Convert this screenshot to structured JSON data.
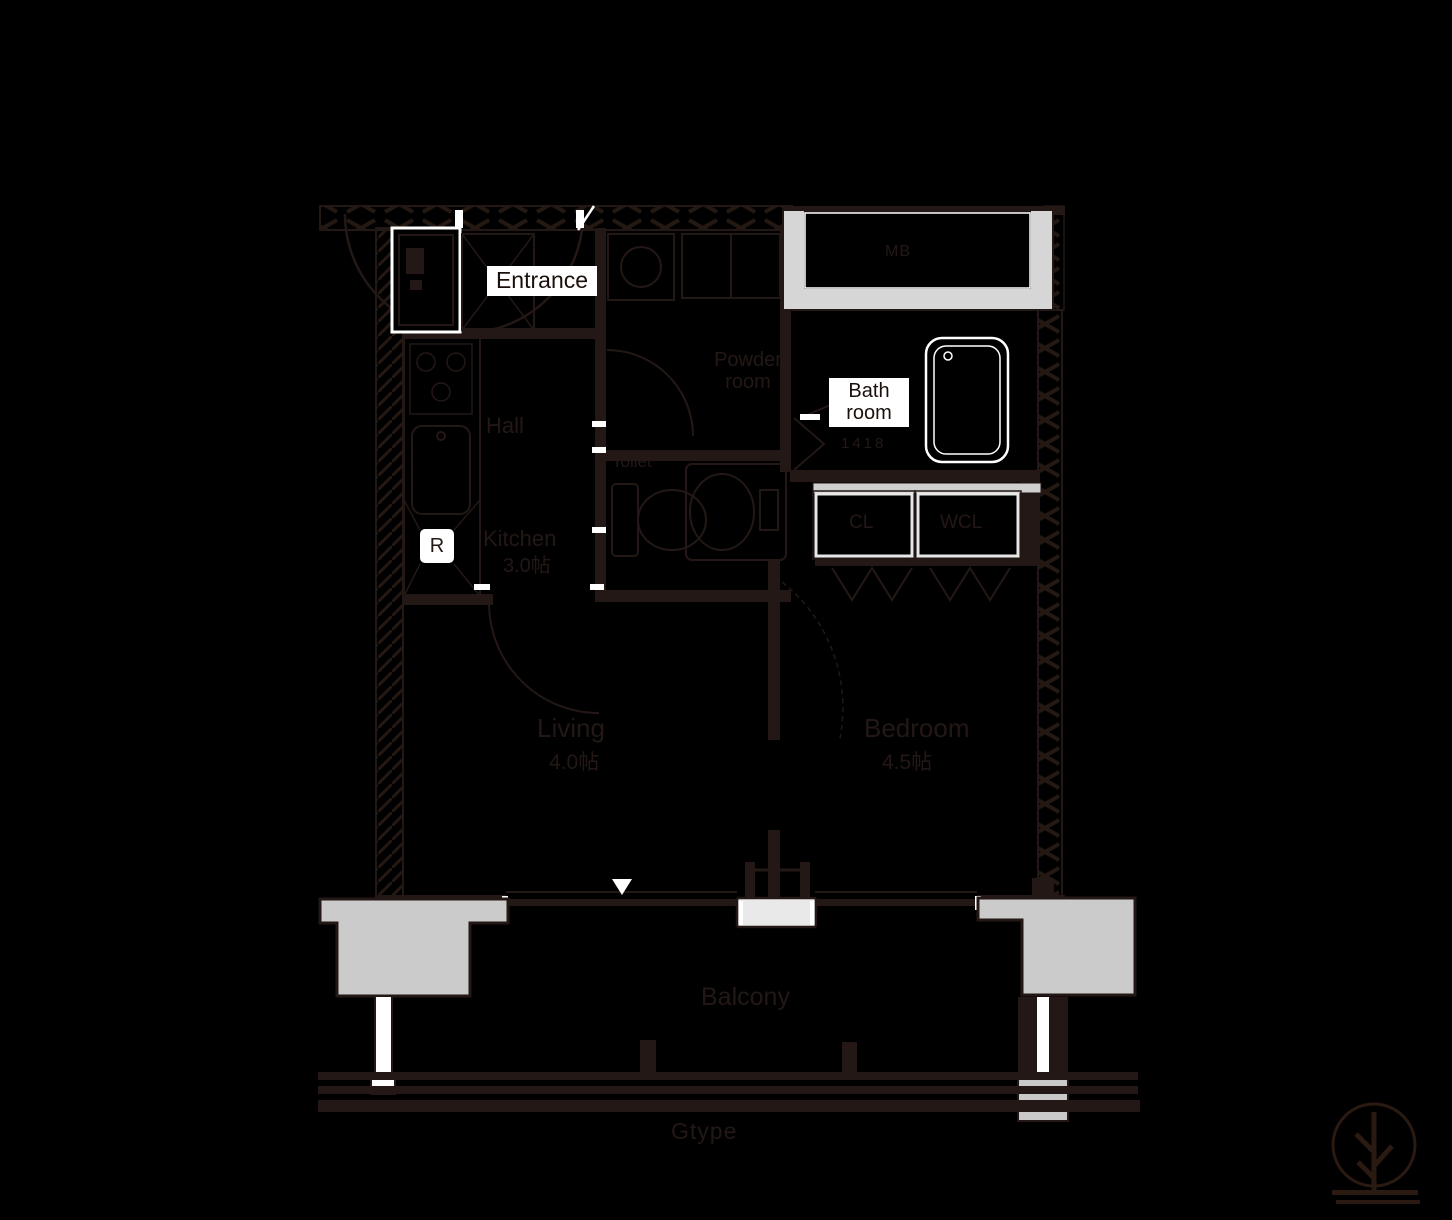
{
  "page": {
    "background": "#000000"
  },
  "plan": {
    "line_color": "#231815",
    "slab_color": "#cbcbcb",
    "labels": {
      "entrance": "Entrance",
      "bath_line1": "Bath",
      "bath_line2": "room",
      "bath_size": "1418",
      "powder_line1": "Powder",
      "powder_line2": "room",
      "hall": "Hall",
      "kitchen": "Kitchen",
      "kitchen_size": "3.0帖",
      "refrigerator": "R",
      "toilet": "Toilet",
      "meter_box": "MB",
      "closet": "CL",
      "walkin_closet": "WCL",
      "living": "Living",
      "living_size": "4.0帖",
      "bedroom": "Bedroom",
      "bedroom_size": "4.5帖",
      "balcony": "Balcony",
      "plan_type": "Gtype"
    }
  }
}
